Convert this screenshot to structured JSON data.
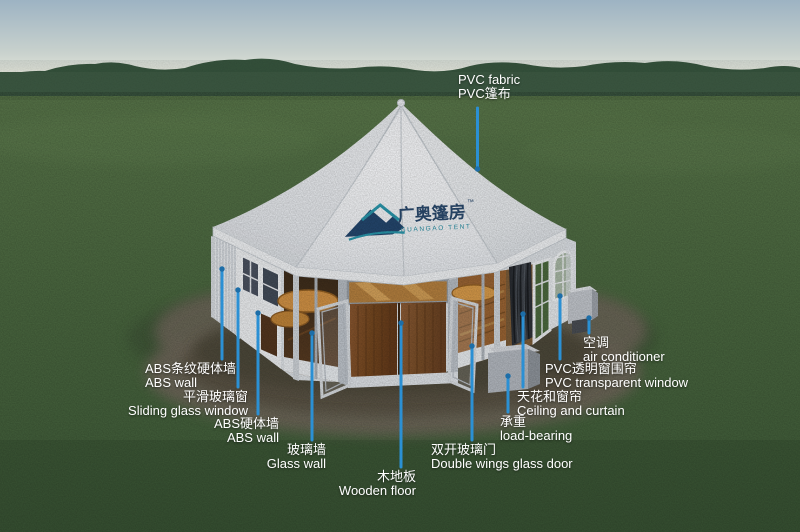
{
  "scene": {
    "description_colors": {
      "callout_blue": "#2b90d4",
      "callout_dot": "#1d6ea8",
      "roof_white": "#f5f6f8",
      "door_wood": "#7a4a24",
      "grass_green": "#4e6b44",
      "sky_top": "#9db3c3",
      "logo_navy": "#24476e",
      "logo_teal": "#2a98ad"
    }
  },
  "logo": {
    "cn": "广奥篷房",
    "tm": "™",
    "en": "GUANGAO TENT"
  },
  "labels": [
    {
      "id": "pvc-fabric",
      "en": "PVC fabric",
      "cn": "PVC篷布"
    },
    {
      "id": "abs-striped-wall",
      "cn": "ABS条纹硬体墙",
      "en": "ABS wall"
    },
    {
      "id": "sliding-window",
      "cn": "平滑玻璃窗",
      "en": "Sliding glass window"
    },
    {
      "id": "abs-wall",
      "cn": "ABS硬体墙",
      "en": "ABS wall"
    },
    {
      "id": "glass-wall",
      "cn": "玻璃墙",
      "en": "Glass wall"
    },
    {
      "id": "wooden-floor",
      "cn": "木地板",
      "en": "Wooden floor"
    },
    {
      "id": "double-glass-door",
      "cn": "双开玻璃门",
      "en": "Double wings glass door"
    },
    {
      "id": "load-bearing",
      "cn": "承重",
      "en": "load-bearing"
    },
    {
      "id": "ceiling-curtain",
      "cn": "天花和窗帘",
      "en": "Ceiling and curtain"
    },
    {
      "id": "pvc-window",
      "cn": "PVC透明窗围帘",
      "en": "PVC transparent window"
    },
    {
      "id": "air-conditioner",
      "cn": "空调",
      "en": "air conditioner"
    }
  ]
}
